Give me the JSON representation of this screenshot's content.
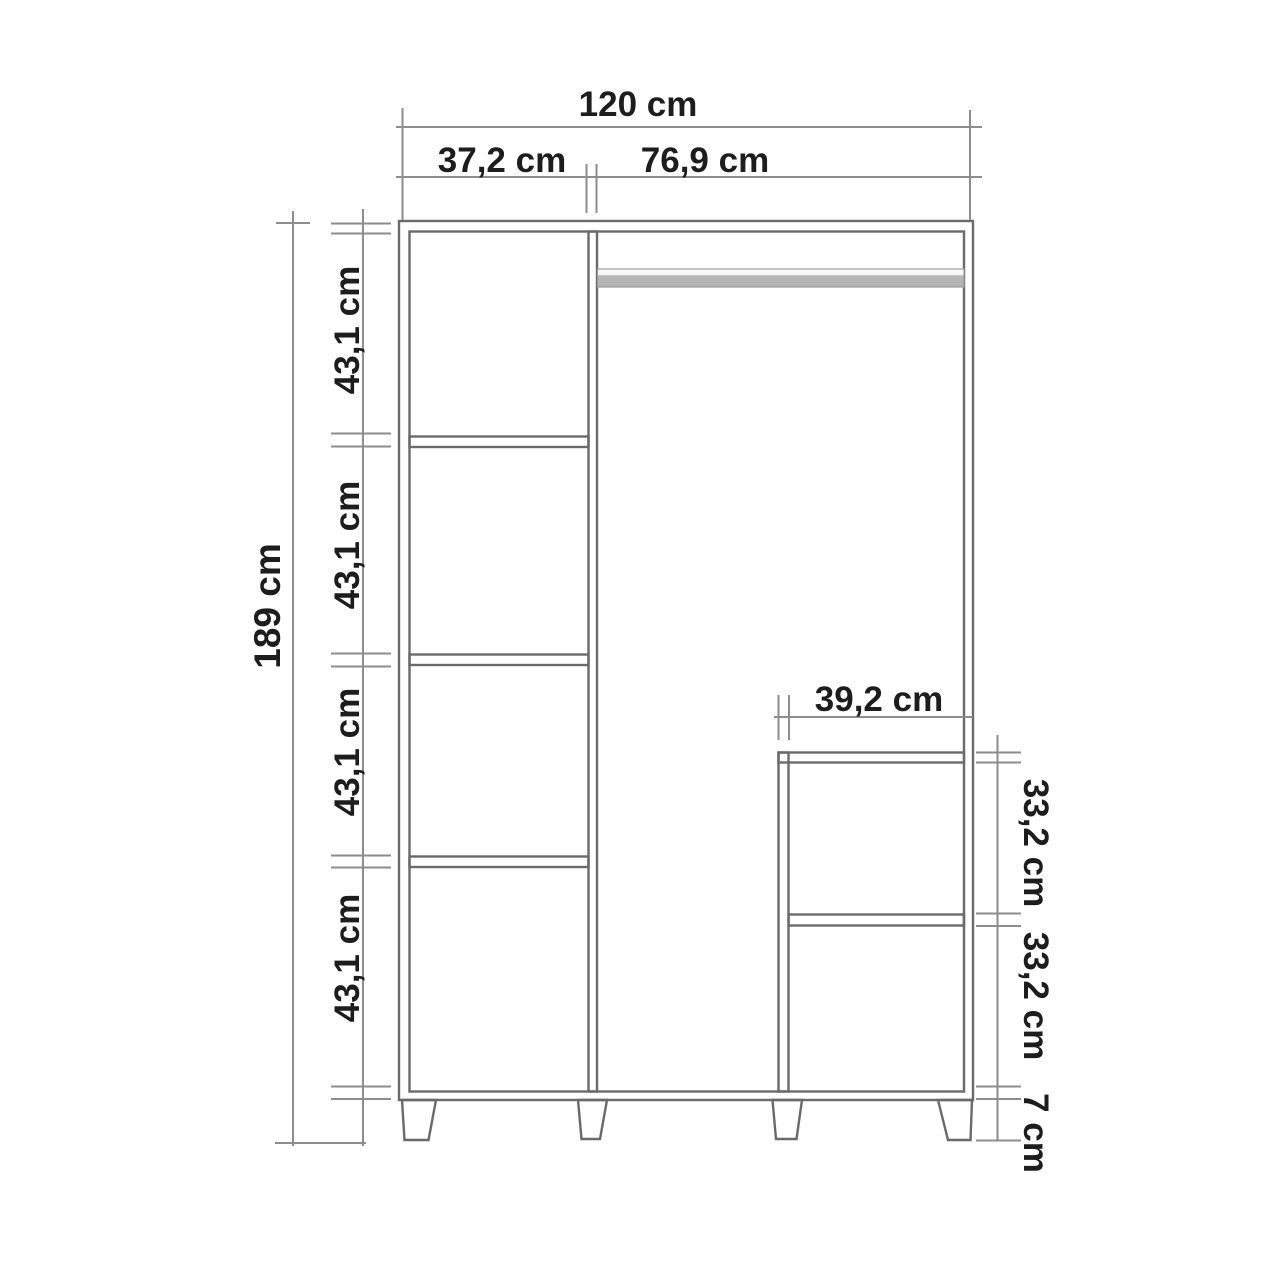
{
  "diagram": {
    "type": "furniture-dimension-drawing",
    "subject": "wardrobe front elevation with dimension chains",
    "units": "cm",
    "colors": {
      "background": "#ffffff",
      "cabinet_line": "#6a6a6a",
      "dimension_line": "#8d8d8d",
      "text": "#1d1d1d",
      "hanging_rail_fill": "#b5b5b5"
    },
    "dimensions": {
      "total_width": {
        "label": "120 cm",
        "value": 120
      },
      "left_column_width": {
        "label": "37,2 cm",
        "value": 37.2
      },
      "right_column_width": {
        "label": "76,9 cm",
        "value": 76.9
      },
      "total_height": {
        "label": "189 cm",
        "value": 189
      },
      "left_shelf_sections": [
        {
          "label": "43,1 cm",
          "value": 43.1
        },
        {
          "label": "43,1 cm",
          "value": 43.1
        },
        {
          "label": "43,1 cm",
          "value": 43.1
        },
        {
          "label": "43,1 cm",
          "value": 43.1
        }
      ],
      "inner_unit_width": {
        "label": "39,2 cm",
        "value": 39.2
      },
      "inner_unit_sections": [
        {
          "label": "33,2 cm",
          "value": 33.2
        },
        {
          "label": "33,2 cm",
          "value": 33.2
        }
      ],
      "leg_height": {
        "label": "7 cm",
        "value": 7
      }
    }
  }
}
